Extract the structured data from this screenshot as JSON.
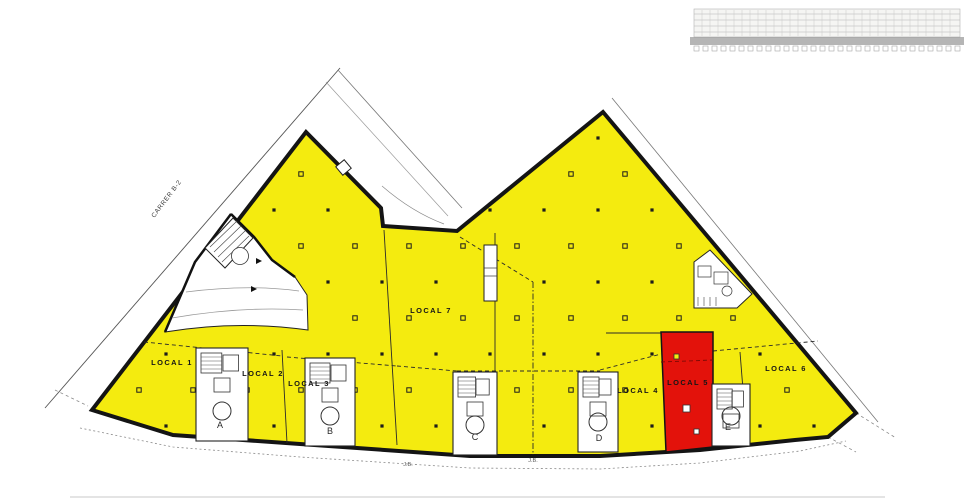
{
  "plan": {
    "street_label": "CARRER B-2",
    "locals": [
      {
        "label": "LOCAL 1",
        "fill": "#f4eb0f",
        "status": "available"
      },
      {
        "label": "LOCAL 2",
        "fill": "#f4eb0f",
        "status": "available"
      },
      {
        "label": "LOCAL 3",
        "fill": "#f4eb0f",
        "status": "available"
      },
      {
        "label": "LOCAL 4",
        "fill": "#f4eb0f",
        "status": "available"
      },
      {
        "label": "LOCAL 5",
        "fill": "#e3120b",
        "status": "highlighted"
      },
      {
        "label": "LOCAL 6",
        "fill": "#f4eb0f",
        "status": "available"
      },
      {
        "label": "LOCAL 7",
        "fill": "#f4eb0f",
        "status": "available"
      }
    ],
    "stair_cores": [
      {
        "label": "A"
      },
      {
        "label": "B"
      },
      {
        "label": "C"
      },
      {
        "label": "D"
      },
      {
        "label": "E"
      }
    ],
    "dimension_labels": [
      "J.B.",
      "J.B."
    ],
    "colors": {
      "unit_fill": "#f4eb0f",
      "highlighted_unit_fill": "#e3120b",
      "outline": "#141414",
      "thin_line": "#2a2a2a"
    }
  }
}
